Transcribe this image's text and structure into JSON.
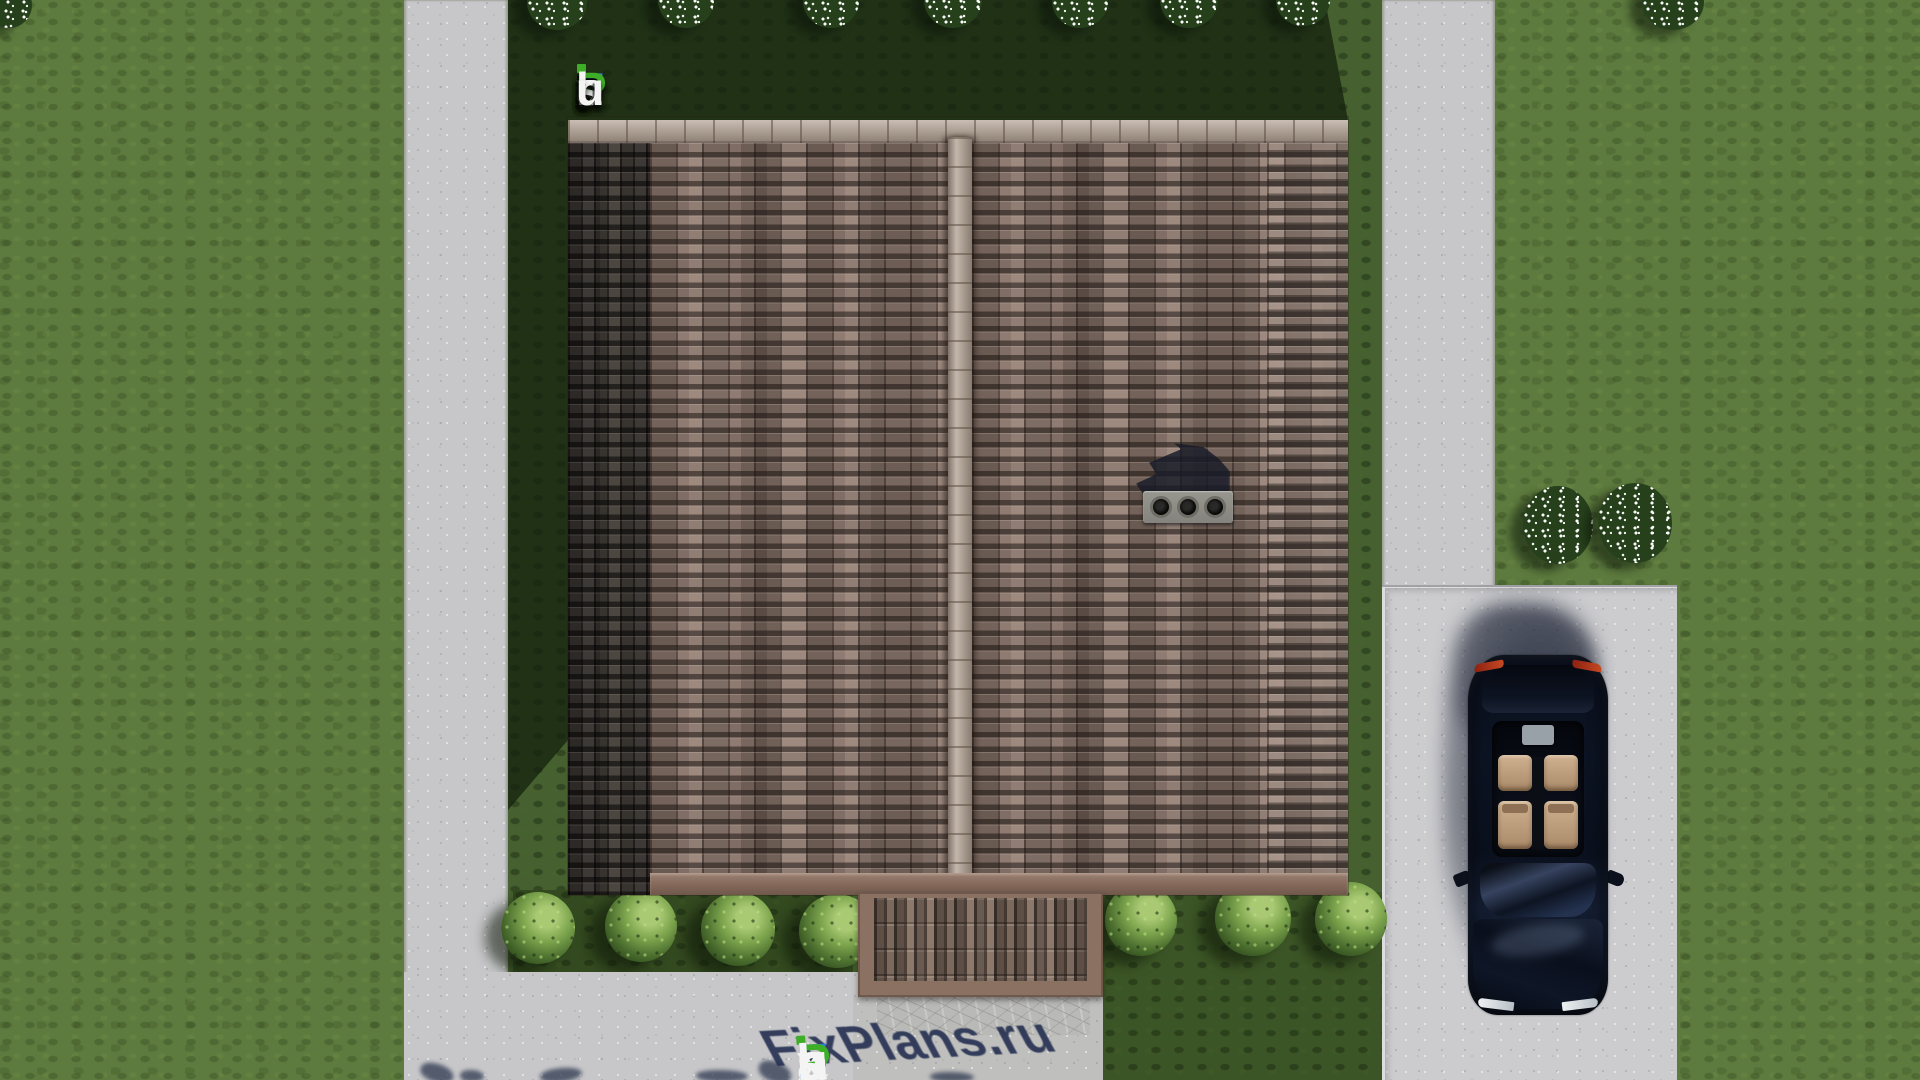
{
  "logo": {
    "text": "FixPlans.ru",
    "letter_colors": [
      "#2e7ce8",
      "#f4f4f4",
      "#f4f4f4",
      "#3fae27",
      "#f4f4f4",
      "#f4f4f4",
      "#f4f4f4",
      "#f4f4f4",
      "#2e7ce8",
      "#f4f4f4",
      "#f4f4f4"
    ],
    "accent_blue": "#2e7ce8",
    "accent_green": "#3fae27",
    "i_dot_color": "#3fae27"
  },
  "watermark": {
    "text": "FixPlans.ru",
    "shadow_color": "#202c4e",
    "position": "bottom edge, partially cut off"
  },
  "scene": {
    "view": "top-down aerial 3D architectural render",
    "objects": {
      "house_roof": "large brown-tiled gable roof with central vertical ridge and light ridge caps",
      "roof_dark_band": "darker shaded tile band along left edge of roof",
      "chimney": "gray chimney block with three round flues on right slope, shadow cast to upper left",
      "porch_roof": "small brown ribbed canopy over entrance at bottom center",
      "entrance_walkway": "stone-textured walkway below porch",
      "car": "dark navy sedan with glass roof and tan interior, parked facing down on driveway",
      "driveway": "light concrete parking pad, right side",
      "garden_path_left": "vertical concrete path on left",
      "garden_path_right": "vertical concrete path on right",
      "patio": "concrete patio across bottom left",
      "lawn": "green lawn surrounding the plot, house shadow cast to upper left",
      "foundation_bushes": "four round shrubs left of porch, three right of walkway",
      "flowering_bushes": "two white-flowering bushes beside driveway corner",
      "flowering_trees_top": "row of white-flowering treetops clipped at top edge"
    }
  },
  "palette": {
    "grass_light": "#5d7b3e",
    "grass_shadow": "#2a4021",
    "concrete": "#c7c7c9",
    "roof_tile": "#8f7b71",
    "roof_dark_band": "#3d3936",
    "ridge_cap": "#b5a596",
    "fascia_brown": "#8a7162",
    "car_body": "#0c1322",
    "car_seats": "#c9ab8a"
  }
}
